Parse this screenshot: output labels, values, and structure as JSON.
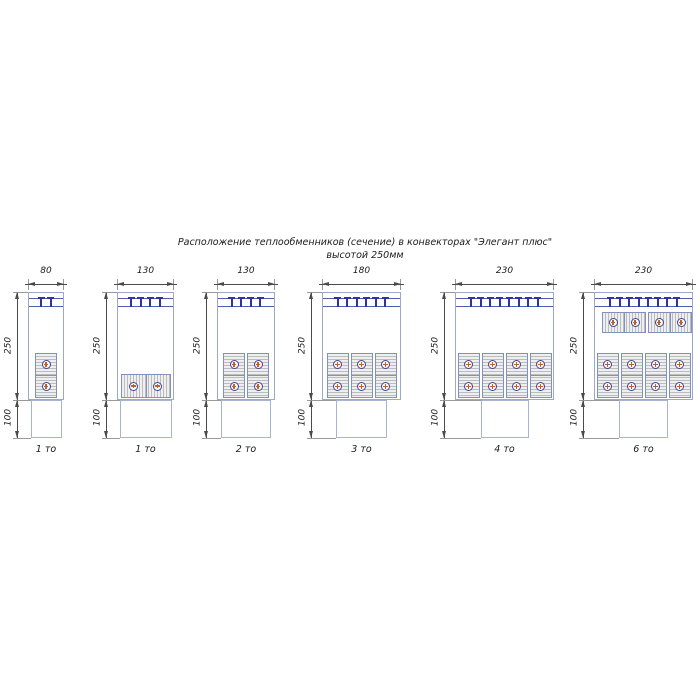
{
  "title": {
    "line1": "Расположение теплообменников (сечение) в конвекторах \"Элегант плюс\"",
    "line2": "высотой 250мм"
  },
  "diagrams": [
    {
      "width_label": "80",
      "body_height_label": "250",
      "plinth_height_label": "100",
      "caption": "1 то",
      "grille_teeth": 2,
      "bottom_orientation": "vertical",
      "bottom_count": 1,
      "top_exchangers": 0,
      "tubes_per_exchanger": 2
    },
    {
      "width_label": "130",
      "body_height_label": "250",
      "plinth_height_label": "100",
      "caption": "1 то",
      "grille_teeth": 4,
      "bottom_orientation": "horizontal",
      "bottom_count": 1,
      "top_exchangers": 0,
      "tubes_per_exchanger": 2
    },
    {
      "width_label": "130",
      "body_height_label": "250",
      "plinth_height_label": "100",
      "caption": "2 то",
      "grille_teeth": 4,
      "bottom_orientation": "vertical",
      "bottom_count": 2,
      "top_exchangers": 0,
      "tubes_per_exchanger": 2
    },
    {
      "width_label": "180",
      "body_height_label": "250",
      "plinth_height_label": "100",
      "caption": "3 то",
      "grille_teeth": 6,
      "bottom_orientation": "vertical",
      "bottom_count": 3,
      "top_exchangers": 0,
      "tubes_per_exchanger": 2
    },
    {
      "width_label": "230",
      "body_height_label": "250",
      "plinth_height_label": "100",
      "caption": "4 то",
      "grille_teeth": 8,
      "bottom_orientation": "vertical",
      "bottom_count": 4,
      "top_exchangers": 0,
      "tubes_per_exchanger": 2
    },
    {
      "width_label": "230",
      "body_height_label": "250",
      "plinth_height_label": "100",
      "caption": "6 то",
      "grille_teeth": 8,
      "bottom_orientation": "vertical",
      "bottom_count": 4,
      "top_exchangers": 2,
      "tubes_per_exchanger": 2
    }
  ],
  "colors": {
    "background": "#ffffff",
    "text": "#1b1b1b",
    "outline_blue": "#9ba7cb",
    "plinth_blue": "#a8b2d2",
    "grille_line_blue": "#4d5fae",
    "bracket_navy": "#2f339b",
    "block_outline": "#8090c0",
    "hatch_light": "#efefef",
    "hatch_dark": "#bcbcbc",
    "tube_ring_navy": "#3a4497",
    "tube_core_orange": "#c2602c",
    "dimension_line": "#4a4a4a",
    "extension_line": "#999999"
  }
}
